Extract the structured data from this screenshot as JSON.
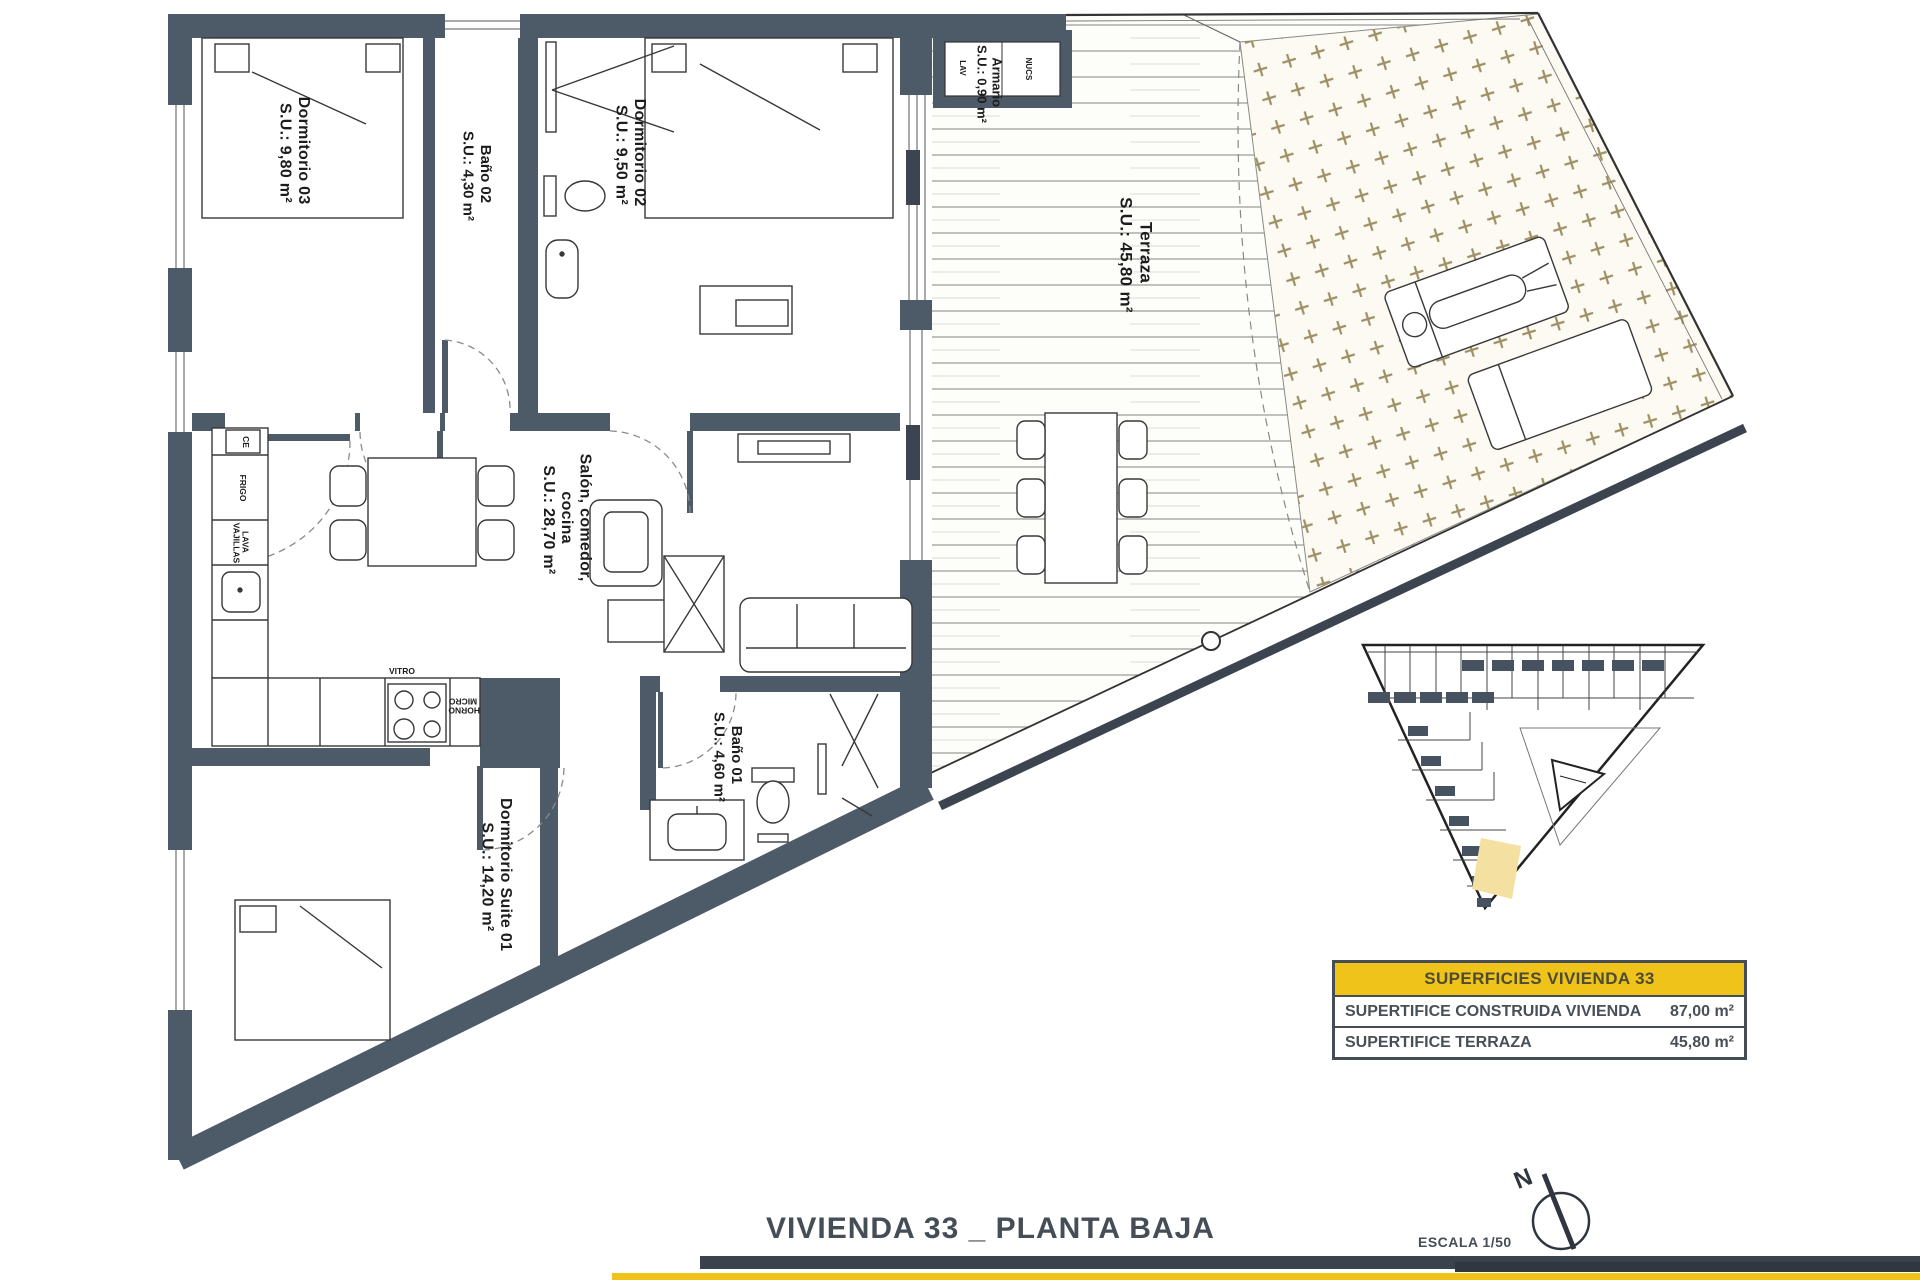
{
  "colors": {
    "wall": "#4d5a68",
    "accent_yellow": "#efc319",
    "dark_text": "#454d57",
    "paving_plus": "#9d9064",
    "keyplan_highlight": "#f4e0a0"
  },
  "rooms": {
    "dormitorio03": {
      "lines": [
        "Dormitorio 03",
        "S.U.: 9,80 m²"
      ]
    },
    "bano02": {
      "lines": [
        "Baño 02",
        "S.U.: 4,30 m²"
      ]
    },
    "dormitorio02": {
      "lines": [
        "Dormitorio 02",
        "S.U.: 9,50 m²"
      ]
    },
    "armario": {
      "lines": [
        "Armario",
        "S.U.: 0,90 m²"
      ]
    },
    "terraza": {
      "lines": [
        "Terraza",
        "S.U.: 45,80 m²"
      ]
    },
    "salon": {
      "lines": [
        "Salón, comedor,",
        "cocina",
        "S.U.: 28,70 m²"
      ]
    },
    "bano01": {
      "lines": [
        "Baño 01",
        "S.U.: 4,60 m²"
      ]
    },
    "suite01": {
      "lines": [
        "Dormitorio Suite 01",
        "S.U.: 14,20 m²"
      ]
    }
  },
  "kitchen": {
    "ce": "CE",
    "frigo": "FRIGO",
    "lava": [
      "LAVA",
      "VAJILLAS"
    ],
    "vitro": "VITRO",
    "horno": [
      "HORNO",
      "MICRO"
    ]
  },
  "armario_cells": {
    "lav": "LAV",
    "nucs": "NUCS"
  },
  "summary": {
    "header": "SUPERFICIES VIVIENDA 33",
    "rows": [
      [
        "SUPERTIFICE CONSTRUIDA VIVIENDA",
        "87,00 m²"
      ],
      [
        "SUPERTIFICE TERRAZA",
        "45,80 m²"
      ]
    ]
  },
  "footer": {
    "title": "VIVIENDA 33 _ PLANTA BAJA",
    "scale": "ESCALA 1/50",
    "north_label": "N"
  }
}
